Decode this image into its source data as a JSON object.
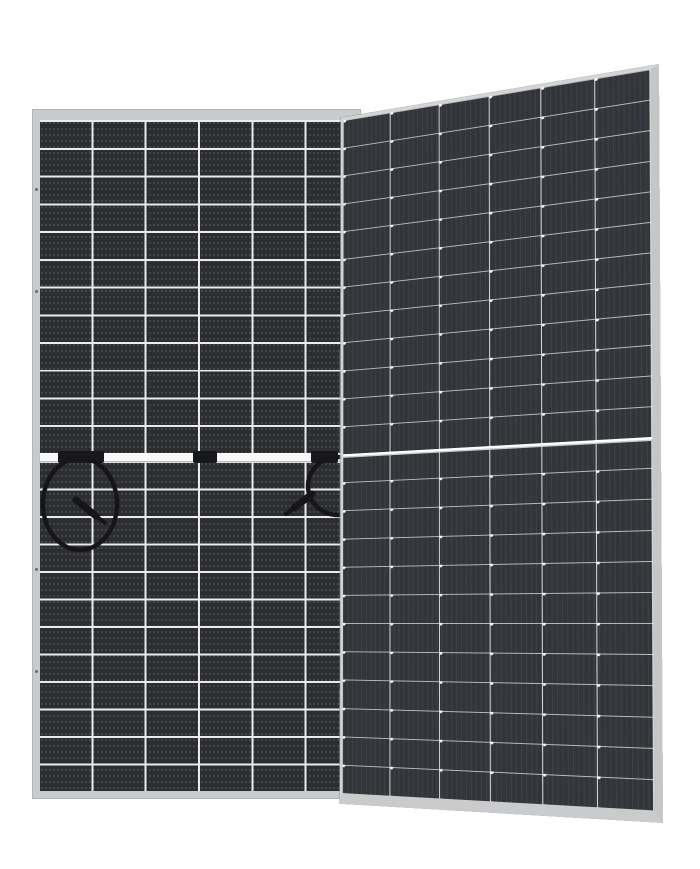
{
  "scene": {
    "type": "product-photo",
    "subject": "Two bifacial monocrystalline solar panels on a white background",
    "left_panel": "rear side, flat frontal view, with center junction-box band and two looped cables with connectors",
    "right_panel": "front side, slightly rotated perspective view"
  },
  "rear_panel": {
    "view": "rear",
    "cell_columns": 6,
    "cell_rows": 24,
    "half_sections": 2,
    "junction_box_count": 3,
    "cable_loop_count": 2,
    "frame": "silver aluminum"
  },
  "front_panel": {
    "view": "front",
    "cell_columns": 6,
    "cell_rows": 24,
    "half_sections": 2,
    "frame": "silver aluminum"
  },
  "colors": {
    "bg": "#ffffff",
    "frame": "#c8cacc",
    "frame-edge": "#9a9da0",
    "rear-cell": "#2b2d31",
    "rear-line": "#ebebeb",
    "front-cell": "#33353a",
    "front-line": "#eceded",
    "band": "#f8f8f8",
    "jbox": "#17181b",
    "cable": "#161616"
  }
}
